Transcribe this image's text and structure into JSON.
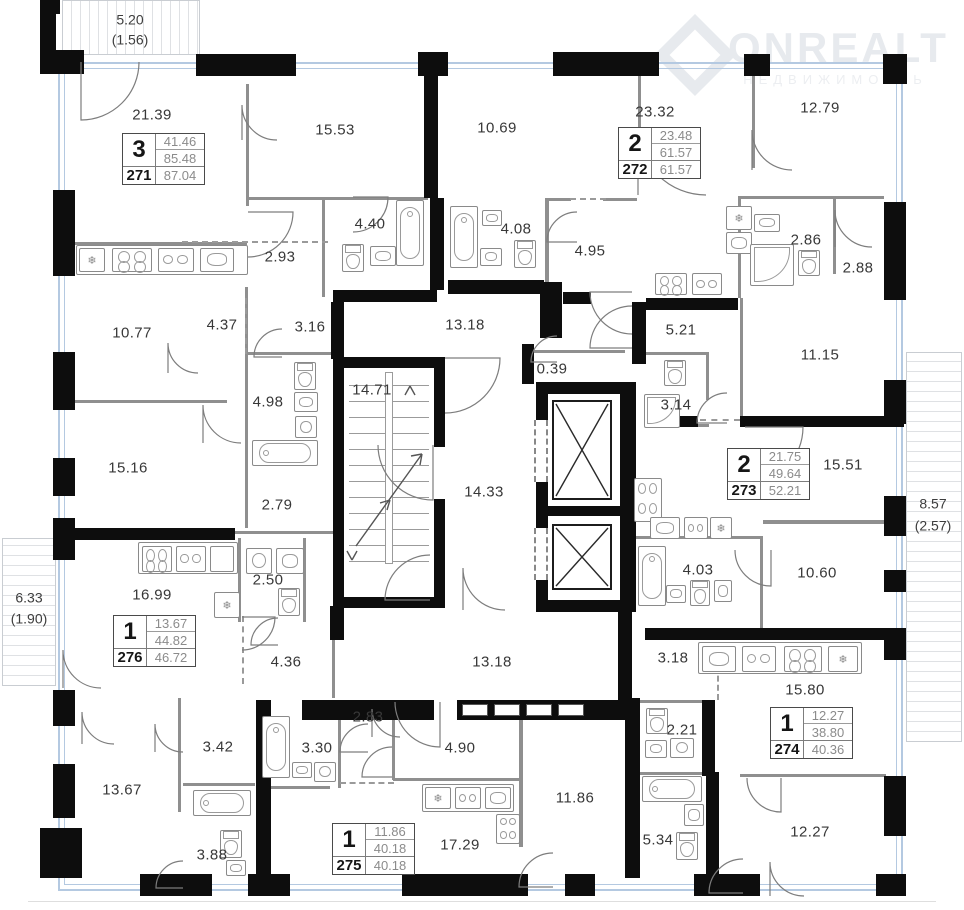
{
  "watermark": {
    "brand": "ONREALT",
    "subtitle": "НЕДВИЖИМОСТЬ"
  },
  "balconies": [
    {
      "id": "balcony-top",
      "area": "5.20",
      "reduced": "(1.56)"
    },
    {
      "id": "balcony-left",
      "area": "6.33",
      "reduced": "(1.90)"
    },
    {
      "id": "balcony-right",
      "area": "8.57",
      "reduced": "(2.57)"
    }
  ],
  "apartments": [
    {
      "number": "271",
      "rooms": "3",
      "living_area": "41.46",
      "area": "85.48",
      "total_area": "87.04"
    },
    {
      "number": "272",
      "rooms": "2",
      "living_area": "23.48",
      "area": "61.57",
      "total_area": "61.57"
    },
    {
      "number": "273",
      "rooms": "2",
      "living_area": "21.75",
      "area": "49.64",
      "total_area": "52.21"
    },
    {
      "number": "274",
      "rooms": "1",
      "living_area": "12.27",
      "area": "38.80",
      "total_area": "40.36"
    },
    {
      "number": "275",
      "rooms": "1",
      "living_area": "11.86",
      "area": "40.18",
      "total_area": "40.18"
    },
    {
      "number": "276",
      "rooms": "1",
      "living_area": "13.67",
      "area": "44.82",
      "total_area": "46.72"
    }
  ],
  "rooms": [
    {
      "id": "room-1",
      "label": "21.39"
    },
    {
      "id": "room-2",
      "label": "15.53"
    },
    {
      "id": "room-3",
      "label": "10.69"
    },
    {
      "id": "room-4",
      "label": "23.32"
    },
    {
      "id": "room-5",
      "label": "12.79"
    },
    {
      "id": "room-6",
      "label": "4.40"
    },
    {
      "id": "room-7",
      "label": "4.08"
    },
    {
      "id": "room-8",
      "label": "4.95"
    },
    {
      "id": "room-9",
      "label": "2.86"
    },
    {
      "id": "room-10",
      "label": "2.88"
    },
    {
      "id": "room-11",
      "label": "2.93"
    },
    {
      "id": "room-12",
      "label": "10.77"
    },
    {
      "id": "room-13",
      "label": "4.37"
    },
    {
      "id": "room-14",
      "label": "3.16"
    },
    {
      "id": "room-15",
      "label": "13.18"
    },
    {
      "id": "room-16",
      "label": "5.21"
    },
    {
      "id": "room-17",
      "label": "11.15"
    },
    {
      "id": "room-18",
      "label": "14.71"
    },
    {
      "id": "room-19",
      "label": "0.39"
    },
    {
      "id": "room-20",
      "label": "3.14"
    },
    {
      "id": "room-21",
      "label": "4.98"
    },
    {
      "id": "room-22",
      "label": "15.51"
    },
    {
      "id": "room-23",
      "label": "15.16"
    },
    {
      "id": "room-24",
      "label": "2.79"
    },
    {
      "id": "room-25",
      "label": "14.33"
    },
    {
      "id": "room-26",
      "label": "2.50"
    },
    {
      "id": "room-27",
      "label": "16.99"
    },
    {
      "id": "room-28",
      "label": "4.03"
    },
    {
      "id": "room-29",
      "label": "10.60"
    },
    {
      "id": "room-30",
      "label": "4.36"
    },
    {
      "id": "room-31",
      "label": "13.18"
    },
    {
      "id": "room-32",
      "label": "3.18"
    },
    {
      "id": "room-33",
      "label": "15.80"
    },
    {
      "id": "room-34",
      "label": "2.83"
    },
    {
      "id": "room-35",
      "label": "3.42"
    },
    {
      "id": "room-36",
      "label": "3.30"
    },
    {
      "id": "room-37",
      "label": "2.21"
    },
    {
      "id": "room-38",
      "label": "4.90"
    },
    {
      "id": "room-39",
      "label": "13.67"
    },
    {
      "id": "room-40",
      "label": "11.86"
    },
    {
      "id": "room-41",
      "label": "17.29"
    },
    {
      "id": "room-42",
      "label": "3.88"
    },
    {
      "id": "room-43",
      "label": "5.34"
    },
    {
      "id": "room-44",
      "label": "12.27"
    }
  ],
  "colors": {
    "wall": "#0d0d0d",
    "partition": "#8f8f8f",
    "window": "#b4c9e1",
    "text": "#383838"
  }
}
